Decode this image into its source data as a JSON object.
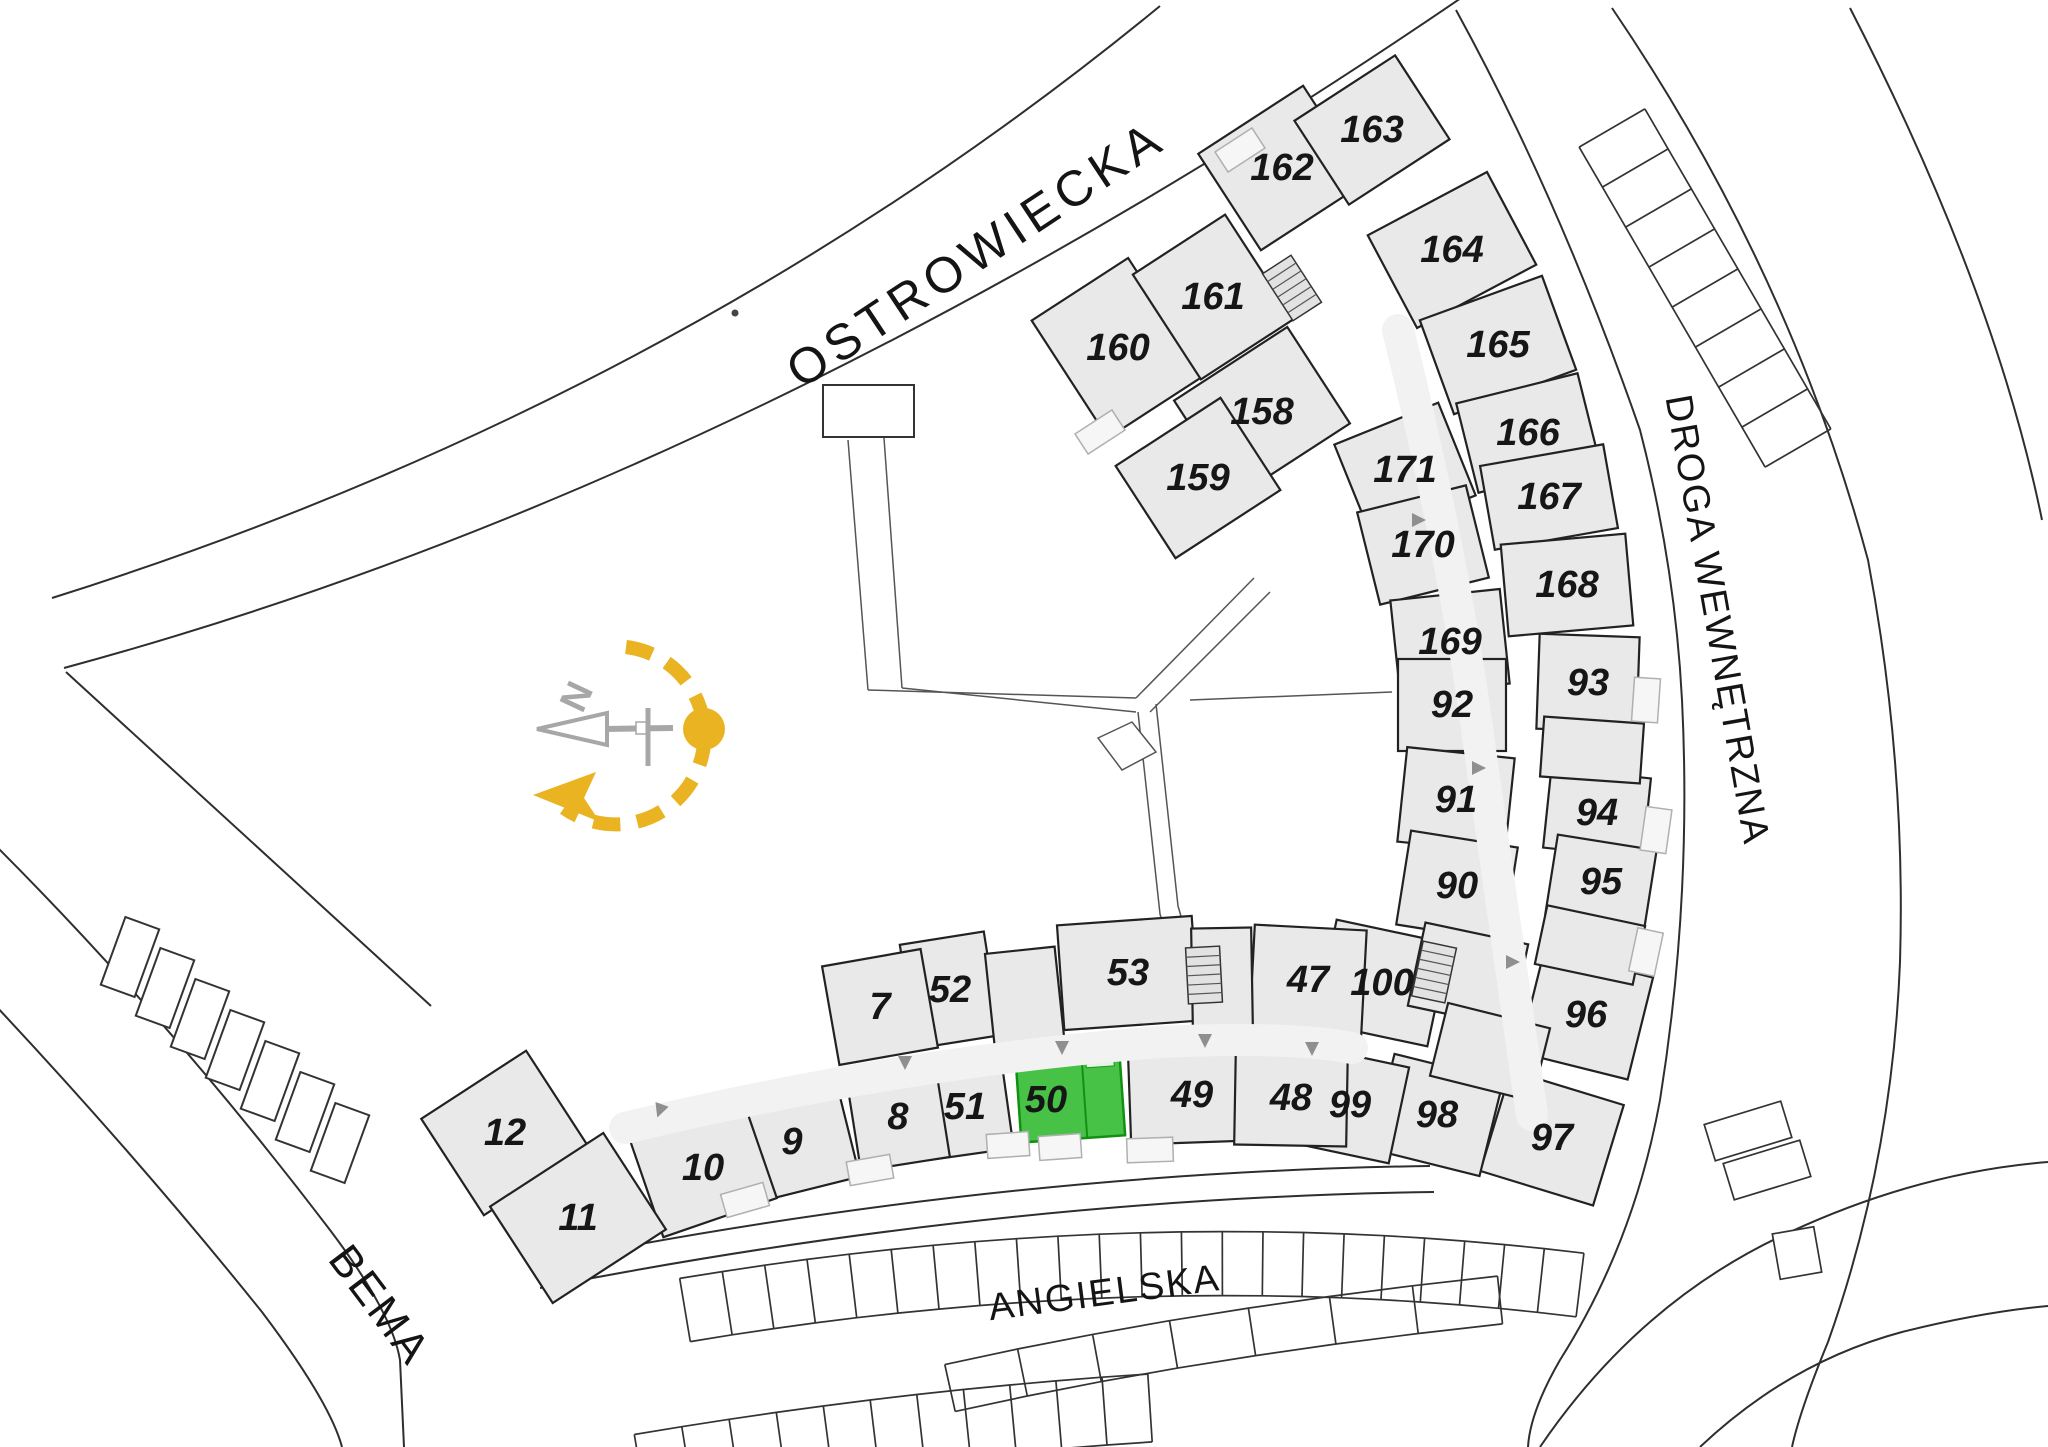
{
  "streets": {
    "ostrowiecka": {
      "label": "OSTROWIECKA"
    },
    "droga_wewnetrzna": {
      "label": "DROGA WEWNĘTRZNA"
    },
    "bema": {
      "label": "BEMA"
    },
    "angielska": {
      "label": "ANGIELSKA"
    }
  },
  "compass": {
    "north_label": "N"
  },
  "highlight": {
    "unit": "50"
  },
  "colors": {
    "building_fill": "#e9e9e9",
    "wall": "#222222",
    "site_line": "#2e2e2e",
    "corridor": "#f2f2f2",
    "arrow": "#8f8f8f",
    "balcony_fill": "#f6f6f6",
    "balcony_stroke": "#b0b0b0",
    "stair_fill": "#e2e2e2",
    "green_fill": "#47c247",
    "green_stroke": "#119111",
    "green_text": "#175c17",
    "compass_yellow": "#e9b322",
    "compass_gray": "#a7a7a7",
    "text": "#141414"
  },
  "units": [
    {
      "n": "160",
      "x": 1118,
      "y": 348,
      "w": 115,
      "h": 140,
      "a": -33
    },
    {
      "n": "161",
      "x": 1213,
      "y": 297,
      "w": 110,
      "h": 125,
      "a": -33
    },
    {
      "n": "162",
      "x": 1282,
      "y": 168,
      "w": 125,
      "h": 115,
      "a": -33
    },
    {
      "n": "163",
      "x": 1372,
      "y": 130,
      "w": 120,
      "h": 100,
      "a": -33
    },
    {
      "n": "158",
      "x": 1262,
      "y": 412,
      "w": 135,
      "h": 115,
      "a": -33
    },
    {
      "n": "159",
      "x": 1198,
      "y": 478,
      "w": 125,
      "h": 110,
      "a": -33
    },
    {
      "n": "164",
      "x": 1452,
      "y": 250,
      "w": 135,
      "h": 105,
      "a": -28
    },
    {
      "n": "165",
      "x": 1498,
      "y": 345,
      "w": 130,
      "h": 100,
      "a": -20
    },
    {
      "n": "166",
      "x": 1528,
      "y": 433,
      "w": 125,
      "h": 92,
      "a": -14
    },
    {
      "n": "167",
      "x": 1549,
      "y": 497,
      "w": 125,
      "h": 85,
      "a": -10
    },
    {
      "n": "168",
      "x": 1567,
      "y": 585,
      "w": 125,
      "h": 92,
      "a": -5
    },
    {
      "n": "171",
      "x": 1405,
      "y": 470,
      "w": 112,
      "h": 100,
      "a": -22
    },
    {
      "n": "170",
      "x": 1423,
      "y": 545,
      "w": 112,
      "h": 95,
      "a": -14
    },
    {
      "n": "169",
      "x": 1450,
      "y": 642,
      "w": 110,
      "h": 95,
      "a": -6
    },
    {
      "n": "92",
      "x": 1452,
      "y": 705,
      "w": 108,
      "h": 92,
      "a": 0
    },
    {
      "n": "93",
      "x": 1588,
      "y": 683,
      "w": 100,
      "h": 95,
      "a": 2
    },
    {
      "n": "91",
      "x": 1456,
      "y": 800,
      "w": 108,
      "h": 95,
      "a": 6
    },
    {
      "n": "94",
      "x": 1597,
      "y": 813,
      "w": 100,
      "h": 80,
      "a": 6
    },
    {
      "n": "90",
      "x": 1457,
      "y": 886,
      "w": 108,
      "h": 95,
      "a": 9
    },
    {
      "n": "95",
      "x": 1601,
      "y": 882,
      "w": 100,
      "h": 80,
      "a": 9
    },
    {
      "n": "96",
      "x": 1586,
      "y": 1015,
      "w": 112,
      "h": 105,
      "a": 14
    },
    {
      "n": "97",
      "x": 1552,
      "y": 1138,
      "w": 118,
      "h": 105,
      "a": 17
    },
    {
      "n": "98",
      "x": 1437,
      "y": 1115,
      "w": 112,
      "h": 98,
      "a": 14
    },
    {
      "n": "100",
      "x": 1382,
      "y": 983,
      "w": 115,
      "h": 105,
      "a": 12
    },
    {
      "n": "99",
      "x": 1350,
      "y": 1105,
      "w": 100,
      "h": 98,
      "a": 12
    },
    {
      "n": "47",
      "x": 1308,
      "y": 980,
      "w": 112,
      "h": 105,
      "a": 3
    },
    {
      "n": "53",
      "x": 1128,
      "y": 973,
      "w": 135,
      "h": 105,
      "a": -4
    },
    {
      "n": "52",
      "x": 950,
      "y": 990,
      "w": 85,
      "h": 105,
      "a": -9
    },
    {
      "n": "7",
      "x": 880,
      "y": 1007,
      "w": 100,
      "h": 100,
      "a": -10
    },
    {
      "n": "51",
      "x": 965,
      "y": 1107,
      "w": 85,
      "h": 95,
      "a": -8
    },
    {
      "n": "8",
      "x": 898,
      "y": 1117,
      "w": 90,
      "h": 95,
      "a": -9
    },
    {
      "n": "50",
      "x": 1070,
      "y": 1092,
      "w": 104,
      "h": 94,
      "a": -4,
      "green": true,
      "lx": 1046,
      "ly": 1100
    },
    {
      "n": "49",
      "x": 1192,
      "y": 1095,
      "w": 125,
      "h": 95,
      "a": -2
    },
    {
      "n": "48",
      "x": 1291,
      "y": 1098,
      "w": 112,
      "h": 95,
      "a": 1
    },
    {
      "n": "9",
      "x": 792,
      "y": 1142,
      "w": 115,
      "h": 100,
      "a": -14
    },
    {
      "n": "10",
      "x": 703,
      "y": 1168,
      "w": 120,
      "h": 105,
      "a": -19
    },
    {
      "n": "12",
      "x": 505,
      "y": 1133,
      "w": 125,
      "h": 115,
      "a": -33
    },
    {
      "n": "11",
      "x": 578,
      "y": 1218,
      "w": 135,
      "h": 115,
      "a": -33
    },
    {
      "n": "",
      "x": 1025,
      "y": 1000,
      "w": 70,
      "h": 100,
      "a": -6
    },
    {
      "n": "",
      "x": 1222,
      "y": 978,
      "w": 60,
      "h": 100,
      "a": -1
    },
    {
      "n": "",
      "x": 1590,
      "y": 945,
      "w": 100,
      "h": 60,
      "a": 12
    },
    {
      "n": "",
      "x": 1468,
      "y": 975,
      "w": 105,
      "h": 85,
      "a": 12
    },
    {
      "n": "",
      "x": 1490,
      "y": 1052,
      "w": 105,
      "h": 75,
      "a": 14
    },
    {
      "n": "",
      "x": 1592,
      "y": 750,
      "w": 100,
      "h": 60,
      "a": 4
    }
  ],
  "parking": {
    "angielska_stalls": 22,
    "angielska_lower_segments": 7,
    "bottom_row_stalls": 11,
    "droga_ladder_stalls": 8,
    "bema_garages": 7,
    "right_side_stalls": 2
  }
}
